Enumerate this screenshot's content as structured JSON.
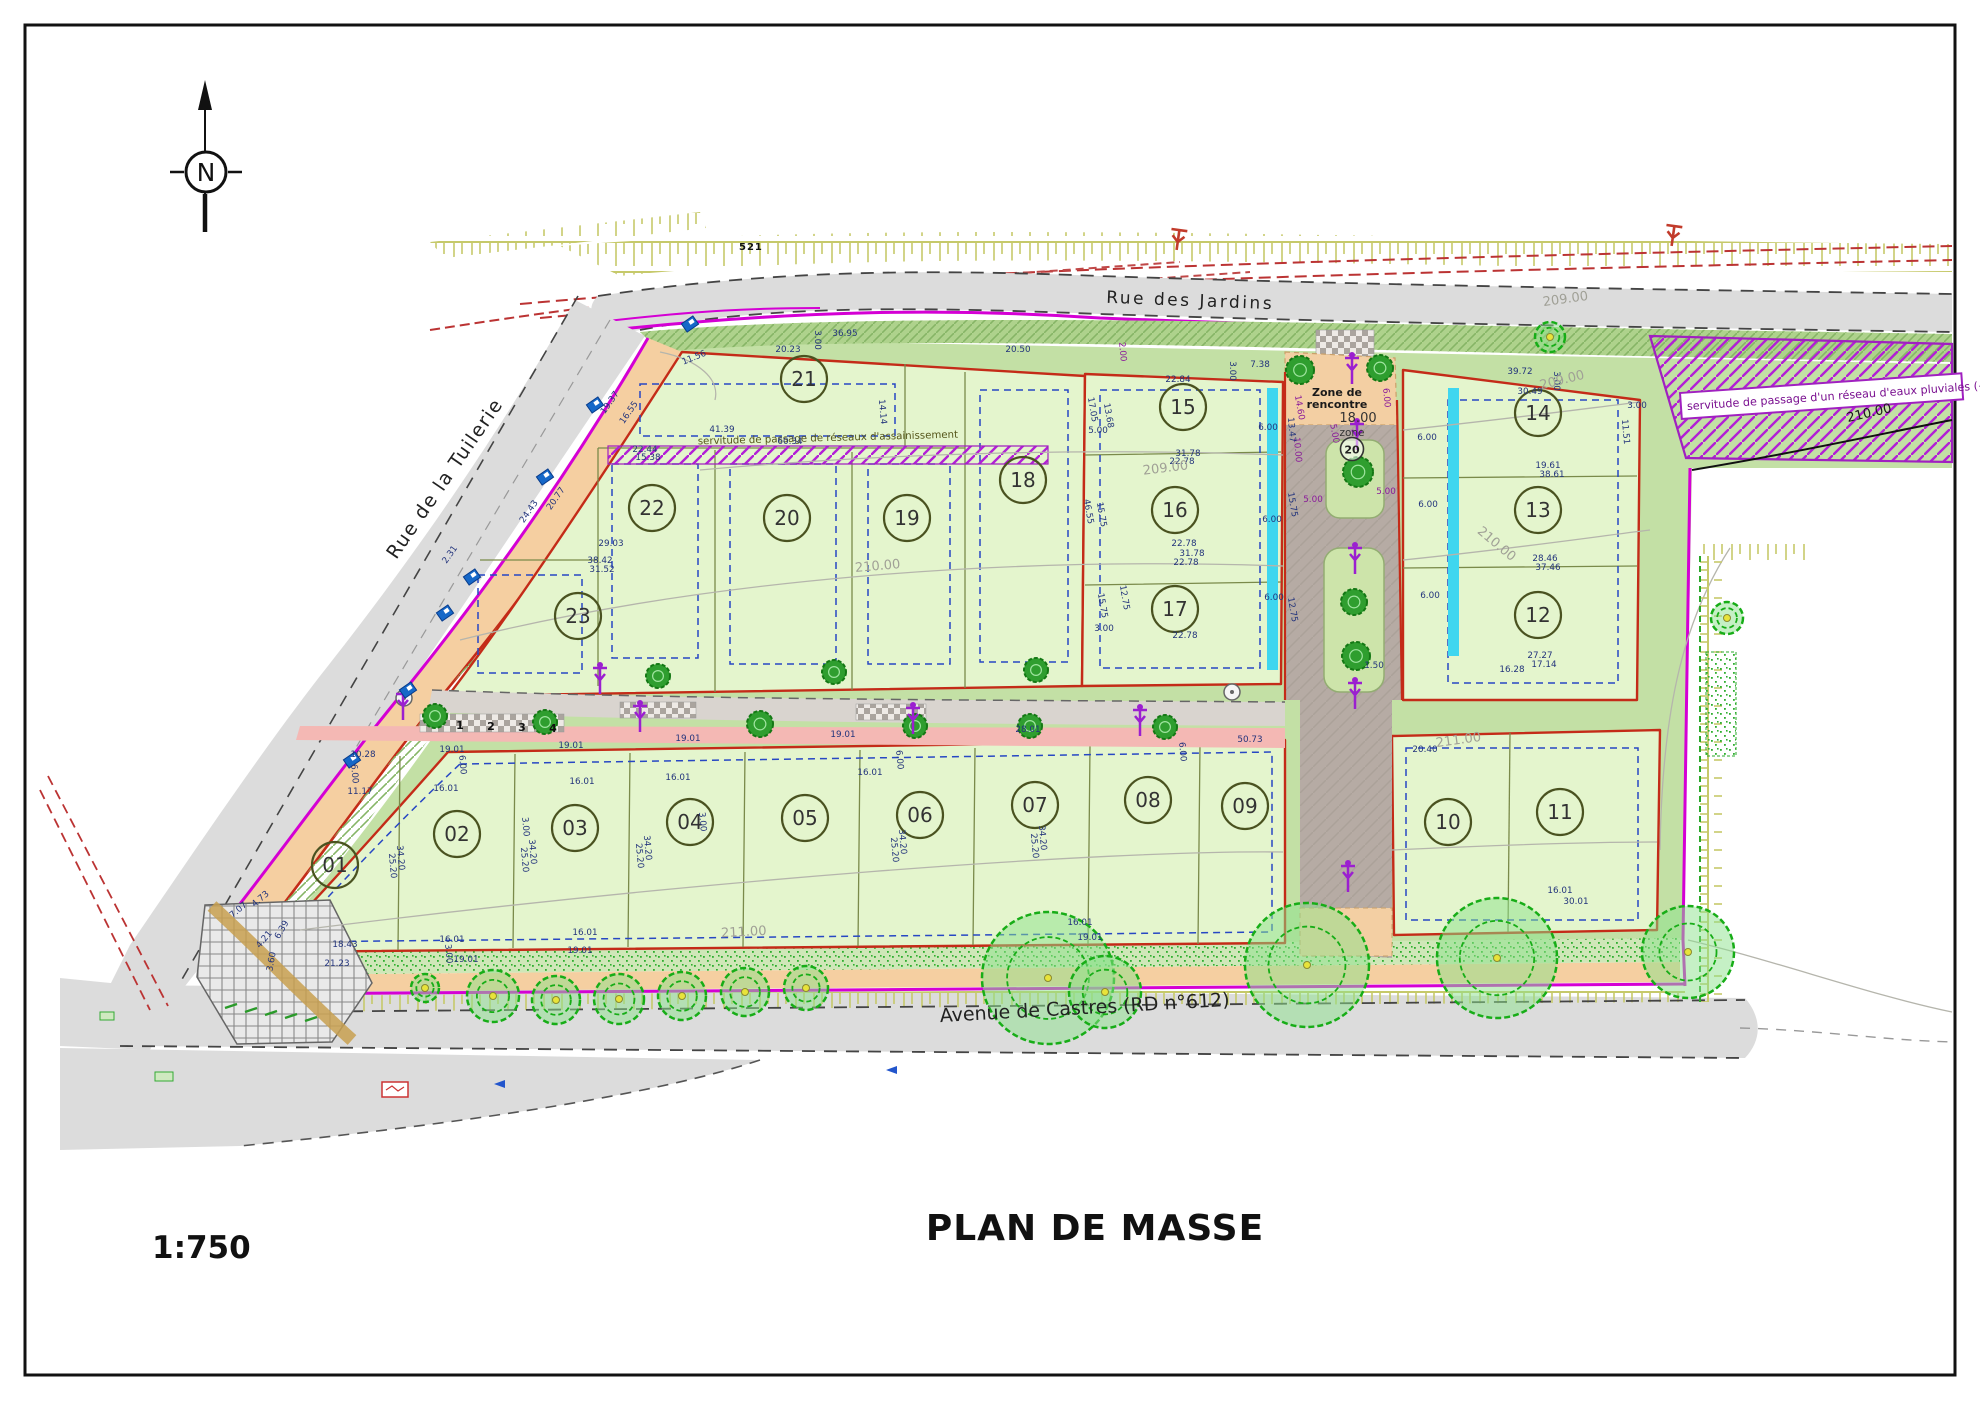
{
  "title": "PLAN DE MASSE",
  "scale": "1:750",
  "north_letter": "N",
  "streets": {
    "jardins": "Rue  des Jardins",
    "tuilerie": "Rue  de la Tuilerie",
    "castres": "Avenue de Castres (RD n°612)"
  },
  "annotations": {
    "servitude_pluviales": "servitude de passage d'un réseau d'eaux pluviales (~70mlx",
    "servitude_assainissement": "servitude de passage de réseaux d'assainissement",
    "zone_rencontre_line1": "Zone de",
    "zone_rencontre_line2": "rencontre",
    "zone_dim": "18.00",
    "zone_word": "zone",
    "zone_speed": "20",
    "benchmark": "521"
  },
  "colors": {
    "boundary_red": "#c42b18",
    "boundary_magenta": "#d400d4",
    "servitude_purple": "#a020c0",
    "dim_blue": "#23347c",
    "dim_purple": "#8a1a9a",
    "lot_fill": "#e4f5cd",
    "verge_green": "#aed28c",
    "road_grey": "#dcdcdc",
    "tree_green": "#17ad17",
    "cyan_swale": "#3fd6ef",
    "contour_grey": "#a0a096"
  },
  "lots": [
    {
      "id": "01",
      "x": 335,
      "y": 865
    },
    {
      "id": "02",
      "x": 457,
      "y": 834
    },
    {
      "id": "03",
      "x": 575,
      "y": 828
    },
    {
      "id": "04",
      "x": 690,
      "y": 822
    },
    {
      "id": "05",
      "x": 805,
      "y": 818
    },
    {
      "id": "06",
      "x": 920,
      "y": 815
    },
    {
      "id": "07",
      "x": 1035,
      "y": 805
    },
    {
      "id": "08",
      "x": 1148,
      "y": 800
    },
    {
      "id": "09",
      "x": 1245,
      "y": 806
    },
    {
      "id": "10",
      "x": 1448,
      "y": 822
    },
    {
      "id": "11",
      "x": 1560,
      "y": 812
    },
    {
      "id": "12",
      "x": 1538,
      "y": 615
    },
    {
      "id": "13",
      "x": 1538,
      "y": 510
    },
    {
      "id": "14",
      "x": 1538,
      "y": 413
    },
    {
      "id": "15",
      "x": 1183,
      "y": 407
    },
    {
      "id": "16",
      "x": 1175,
      "y": 510
    },
    {
      "id": "17",
      "x": 1175,
      "y": 609
    },
    {
      "id": "18",
      "x": 1023,
      "y": 480
    },
    {
      "id": "19",
      "x": 907,
      "y": 518
    },
    {
      "id": "20",
      "x": 787,
      "y": 518
    },
    {
      "id": "21",
      "x": 804,
      "y": 379
    },
    {
      "id": "22",
      "x": 652,
      "y": 508
    },
    {
      "id": "23",
      "x": 578,
      "y": 616
    }
  ],
  "contour_labels": [
    {
      "t": "209.00",
      "x": 1166,
      "y": 472,
      "r": -7
    },
    {
      "t": "209.00",
      "x": 1563,
      "y": 384,
      "r": -14
    },
    {
      "t": "209.00",
      "x": 1566,
      "y": 303,
      "r": -8
    },
    {
      "t": "210.00",
      "x": 878,
      "y": 570,
      "r": -5
    },
    {
      "t": "210.00",
      "x": 1494,
      "y": 547,
      "r": 40
    },
    {
      "t": "211.00",
      "x": 744,
      "y": 936,
      "r": -3
    },
    {
      "t": "211.00",
      "x": 1459,
      "y": 744,
      "r": -8
    },
    {
      "t": "210.00",
      "x": 1870,
      "y": 417,
      "r": -13,
      "c": "#1a1a1a"
    }
  ],
  "tree_numbers": [
    {
      "t": "1",
      "x": 460,
      "y": 729
    },
    {
      "t": "2",
      "x": 491,
      "y": 730
    },
    {
      "t": "3",
      "x": 522,
      "y": 731
    },
    {
      "t": "4",
      "x": 553,
      "y": 732
    }
  ],
  "dimensions": [
    {
      "t": "39.72",
      "x": 1520,
      "y": 374
    },
    {
      "t": "30.49",
      "x": 1530,
      "y": 394
    },
    {
      "t": "3.00",
      "x": 1554,
      "y": 381,
      "r": 90
    },
    {
      "t": "3.00",
      "x": 1637,
      "y": 408
    },
    {
      "t": "11.51",
      "x": 1623,
      "y": 432,
      "r": 85
    },
    {
      "t": "7.38",
      "x": 1260,
      "y": 367
    },
    {
      "t": "22.84",
      "x": 1178,
      "y": 382
    },
    {
      "t": "3.00",
      "x": 1230,
      "y": 371,
      "r": 90
    },
    {
      "t": "17.05",
      "x": 1090,
      "y": 410,
      "r": 80
    },
    {
      "t": "13.68",
      "x": 1106,
      "y": 416,
      "r": 80
    },
    {
      "t": "5.00",
      "x": 1098,
      "y": 433
    },
    {
      "t": "6.00",
      "x": 1268,
      "y": 430
    },
    {
      "t": "31.78",
      "x": 1188,
      "y": 456
    },
    {
      "t": "22.78",
      "x": 1182,
      "y": 464
    },
    {
      "t": "46.55",
      "x": 1086,
      "y": 512,
      "r": 80
    },
    {
      "t": "15.75",
      "x": 1099,
      "y": 515,
      "r": 80
    },
    {
      "t": "15.75",
      "x": 1290,
      "y": 505,
      "r": 80
    },
    {
      "t": "6.00",
      "x": 1272,
      "y": 522
    },
    {
      "t": "22.78",
      "x": 1184,
      "y": 546
    },
    {
      "t": "31.78",
      "x": 1192,
      "y": 556
    },
    {
      "t": "22.78",
      "x": 1186,
      "y": 565
    },
    {
      "t": "12.75",
      "x": 1122,
      "y": 598,
      "r": 80
    },
    {
      "t": "15.75",
      "x": 1100,
      "y": 606,
      "r": 80
    },
    {
      "t": "3.00",
      "x": 1104,
      "y": 631
    },
    {
      "t": "22.78",
      "x": 1185,
      "y": 638
    },
    {
      "t": "6.00",
      "x": 1274,
      "y": 600
    },
    {
      "t": "12.75",
      "x": 1290,
      "y": 610,
      "r": 80
    },
    {
      "t": "20.50",
      "x": 1018,
      "y": 352
    },
    {
      "t": "2.00",
      "x": 1120,
      "y": 352,
      "r": 85,
      "c": "#8a1a9a"
    },
    {
      "t": "36.95",
      "x": 845,
      "y": 336
    },
    {
      "t": "3.00",
      "x": 815,
      "y": 340,
      "r": 90
    },
    {
      "t": "20.23",
      "x": 788,
      "y": 352
    },
    {
      "t": "11.56",
      "x": 695,
      "y": 360,
      "r": -22
    },
    {
      "t": "14.14",
      "x": 880,
      "y": 412,
      "r": 85
    },
    {
      "t": "41.39",
      "x": 722,
      "y": 432
    },
    {
      "t": "60.34",
      "x": 790,
      "y": 444
    },
    {
      "t": "22.44",
      "x": 645,
      "y": 452
    },
    {
      "t": "15.38",
      "x": 648,
      "y": 460
    },
    {
      "t": "19.37",
      "x": 612,
      "y": 404,
      "r": -55
    },
    {
      "t": "16.55",
      "x": 631,
      "y": 414,
      "r": -55
    },
    {
      "t": "24.43",
      "x": 531,
      "y": 513,
      "r": -55
    },
    {
      "t": "20.77",
      "x": 558,
      "y": 500,
      "r": -55
    },
    {
      "t": "2.31",
      "x": 452,
      "y": 556,
      "r": -55
    },
    {
      "t": "29.03",
      "x": 611,
      "y": 546
    },
    {
      "t": "38.42",
      "x": 600,
      "y": 563
    },
    {
      "t": "31.52",
      "x": 602,
      "y": 572
    },
    {
      "t": "19.61",
      "x": 1548,
      "y": 468
    },
    {
      "t": "38.61",
      "x": 1552,
      "y": 477
    },
    {
      "t": "28.46",
      "x": 1545,
      "y": 561
    },
    {
      "t": "37.46",
      "x": 1548,
      "y": 570
    },
    {
      "t": "27.27",
      "x": 1540,
      "y": 658
    },
    {
      "t": "17.14",
      "x": 1544,
      "y": 667
    },
    {
      "t": "16.28",
      "x": 1512,
      "y": 672
    },
    {
      "t": "6.00",
      "x": 1427,
      "y": 440
    },
    {
      "t": "6.00",
      "x": 1428,
      "y": 507
    },
    {
      "t": "6.00",
      "x": 1430,
      "y": 598
    },
    {
      "t": "14.60",
      "x": 1297,
      "y": 408,
      "r": 80,
      "c": "#8a1a9a"
    },
    {
      "t": "10.00",
      "x": 1295,
      "y": 450,
      "r": 85,
      "c": "#8a1a9a"
    },
    {
      "t": "5.00",
      "x": 1332,
      "y": 434,
      "r": 80,
      "c": "#8a1a9a"
    },
    {
      "t": "6.00",
      "x": 1384,
      "y": 398,
      "r": 85,
      "c": "#8a1a9a"
    },
    {
      "t": "5.00",
      "x": 1313,
      "y": 502,
      "c": "#8a1a9a"
    },
    {
      "t": "5.00",
      "x": 1386,
      "y": 494,
      "c": "#8a1a9a"
    },
    {
      "t": "13.47",
      "x": 1289,
      "y": 430,
      "r": 85
    },
    {
      "t": "1.50",
      "x": 1374,
      "y": 668
    },
    {
      "t": "19.01",
      "x": 452,
      "y": 752
    },
    {
      "t": "10.28",
      "x": 363,
      "y": 757
    },
    {
      "t": "6.00",
      "x": 352,
      "y": 774,
      "r": 85
    },
    {
      "t": "11.17",
      "x": 360,
      "y": 794
    },
    {
      "t": "16.01",
      "x": 446,
      "y": 791
    },
    {
      "t": "6.00",
      "x": 460,
      "y": 765,
      "r": 85
    },
    {
      "t": "19.01",
      "x": 571,
      "y": 748
    },
    {
      "t": "19.01",
      "x": 688,
      "y": 741
    },
    {
      "t": "16.01",
      "x": 582,
      "y": 784
    },
    {
      "t": "16.01",
      "x": 678,
      "y": 780
    },
    {
      "t": "3.00",
      "x": 523,
      "y": 827,
      "r": 85
    },
    {
      "t": "34.20",
      "x": 398,
      "y": 858,
      "r": 85
    },
    {
      "t": "25.20",
      "x": 390,
      "y": 866,
      "r": 85
    },
    {
      "t": "34.20",
      "x": 530,
      "y": 852,
      "r": 85
    },
    {
      "t": "25.20",
      "x": 522,
      "y": 860,
      "r": 85
    },
    {
      "t": "34.20",
      "x": 645,
      "y": 848,
      "r": 85
    },
    {
      "t": "25.20",
      "x": 637,
      "y": 856,
      "r": 85
    },
    {
      "t": "3.00",
      "x": 700,
      "y": 822,
      "r": 85
    },
    {
      "t": "18.43",
      "x": 345,
      "y": 947
    },
    {
      "t": "21.23",
      "x": 337,
      "y": 966
    },
    {
      "t": "16.01",
      "x": 452,
      "y": 942
    },
    {
      "t": "3.00",
      "x": 446,
      "y": 954,
      "r": 85
    },
    {
      "t": "19.01",
      "x": 466,
      "y": 962
    },
    {
      "t": "19.01",
      "x": 580,
      "y": 953
    },
    {
      "t": "16.01",
      "x": 585,
      "y": 935
    },
    {
      "t": "19.01",
      "x": 843,
      "y": 737
    },
    {
      "t": "16.01",
      "x": 870,
      "y": 775
    },
    {
      "t": "28.01",
      "x": 1028,
      "y": 732
    },
    {
      "t": "34.20",
      "x": 900,
      "y": 842,
      "r": 85
    },
    {
      "t": "25.20",
      "x": 892,
      "y": 850,
      "r": 85
    },
    {
      "t": "34.20",
      "x": 1040,
      "y": 838,
      "r": 85
    },
    {
      "t": "25.20",
      "x": 1032,
      "y": 846,
      "r": 85
    },
    {
      "t": "16.01",
      "x": 1080,
      "y": 925
    },
    {
      "t": "19.01",
      "x": 1090,
      "y": 940
    },
    {
      "t": "20.40",
      "x": 1425,
      "y": 752
    },
    {
      "t": "30.01",
      "x": 1576,
      "y": 904
    },
    {
      "t": "16.01",
      "x": 1560,
      "y": 893
    },
    {
      "t": "7.07",
      "x": 240,
      "y": 912,
      "r": -40
    },
    {
      "t": "4.73",
      "x": 262,
      "y": 901,
      "r": -40
    },
    {
      "t": "6.39",
      "x": 284,
      "y": 931,
      "r": -60
    },
    {
      "t": "4.21",
      "x": 266,
      "y": 941,
      "r": -50
    },
    {
      "t": "3.60",
      "x": 274,
      "y": 962,
      "r": -80
    },
    {
      "t": "50.73",
      "x": 1250,
      "y": 742
    },
    {
      "t": "6.00",
      "x": 897,
      "y": 760,
      "r": 85
    },
    {
      "t": "6.00",
      "x": 1180,
      "y": 752,
      "r": 85
    }
  ]
}
